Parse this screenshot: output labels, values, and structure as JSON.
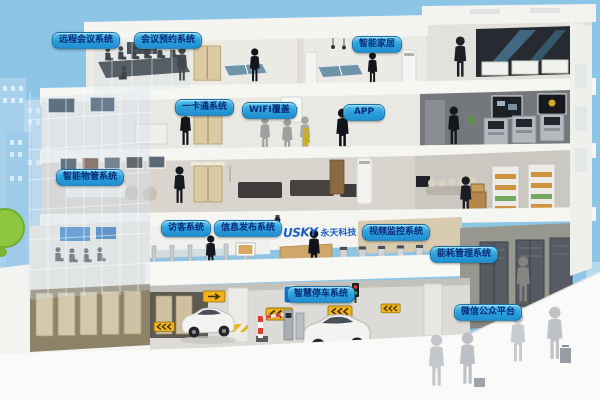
{
  "colors": {
    "sky": "#8cc5e6",
    "label_gradient_top": "#5cc8ef",
    "label_gradient_bottom": "#1f8fd0",
    "label_text": "#0a2a78",
    "logo_blue": "#1a5ec2",
    "sign_yellow": "#f2b21c",
    "bush_green": "#8dc63f"
  },
  "logo": {
    "brand": "USKY",
    "company": "永天科技"
  },
  "labels": {
    "remote_conference": "远程会议系统",
    "meeting_reservation": "会议预约系统",
    "smart_home": "智能家居",
    "one_card": "一卡通系统",
    "wifi_coverage": "WIFI覆盖",
    "app": "APP",
    "property_management": "智能物管系统",
    "visitor": "访客系统",
    "info_publishing": "信息发布系统",
    "video_surveillance": "视频监控系统",
    "energy_management": "能耗管理系统",
    "smart_parking": "智慧停车系统",
    "wechat_platform": "微信公众平台"
  },
  "icons": {
    "wifi_sign": "wifi-signal-board",
    "cctv_camera": "dome-camera",
    "parking_sign": "blue-parking-sign",
    "arrow_sign": "yellow-chevron-arrow-board",
    "lane_signal": "red-green-lane-light",
    "barrier_gate": "striped-barrier-gate"
  }
}
